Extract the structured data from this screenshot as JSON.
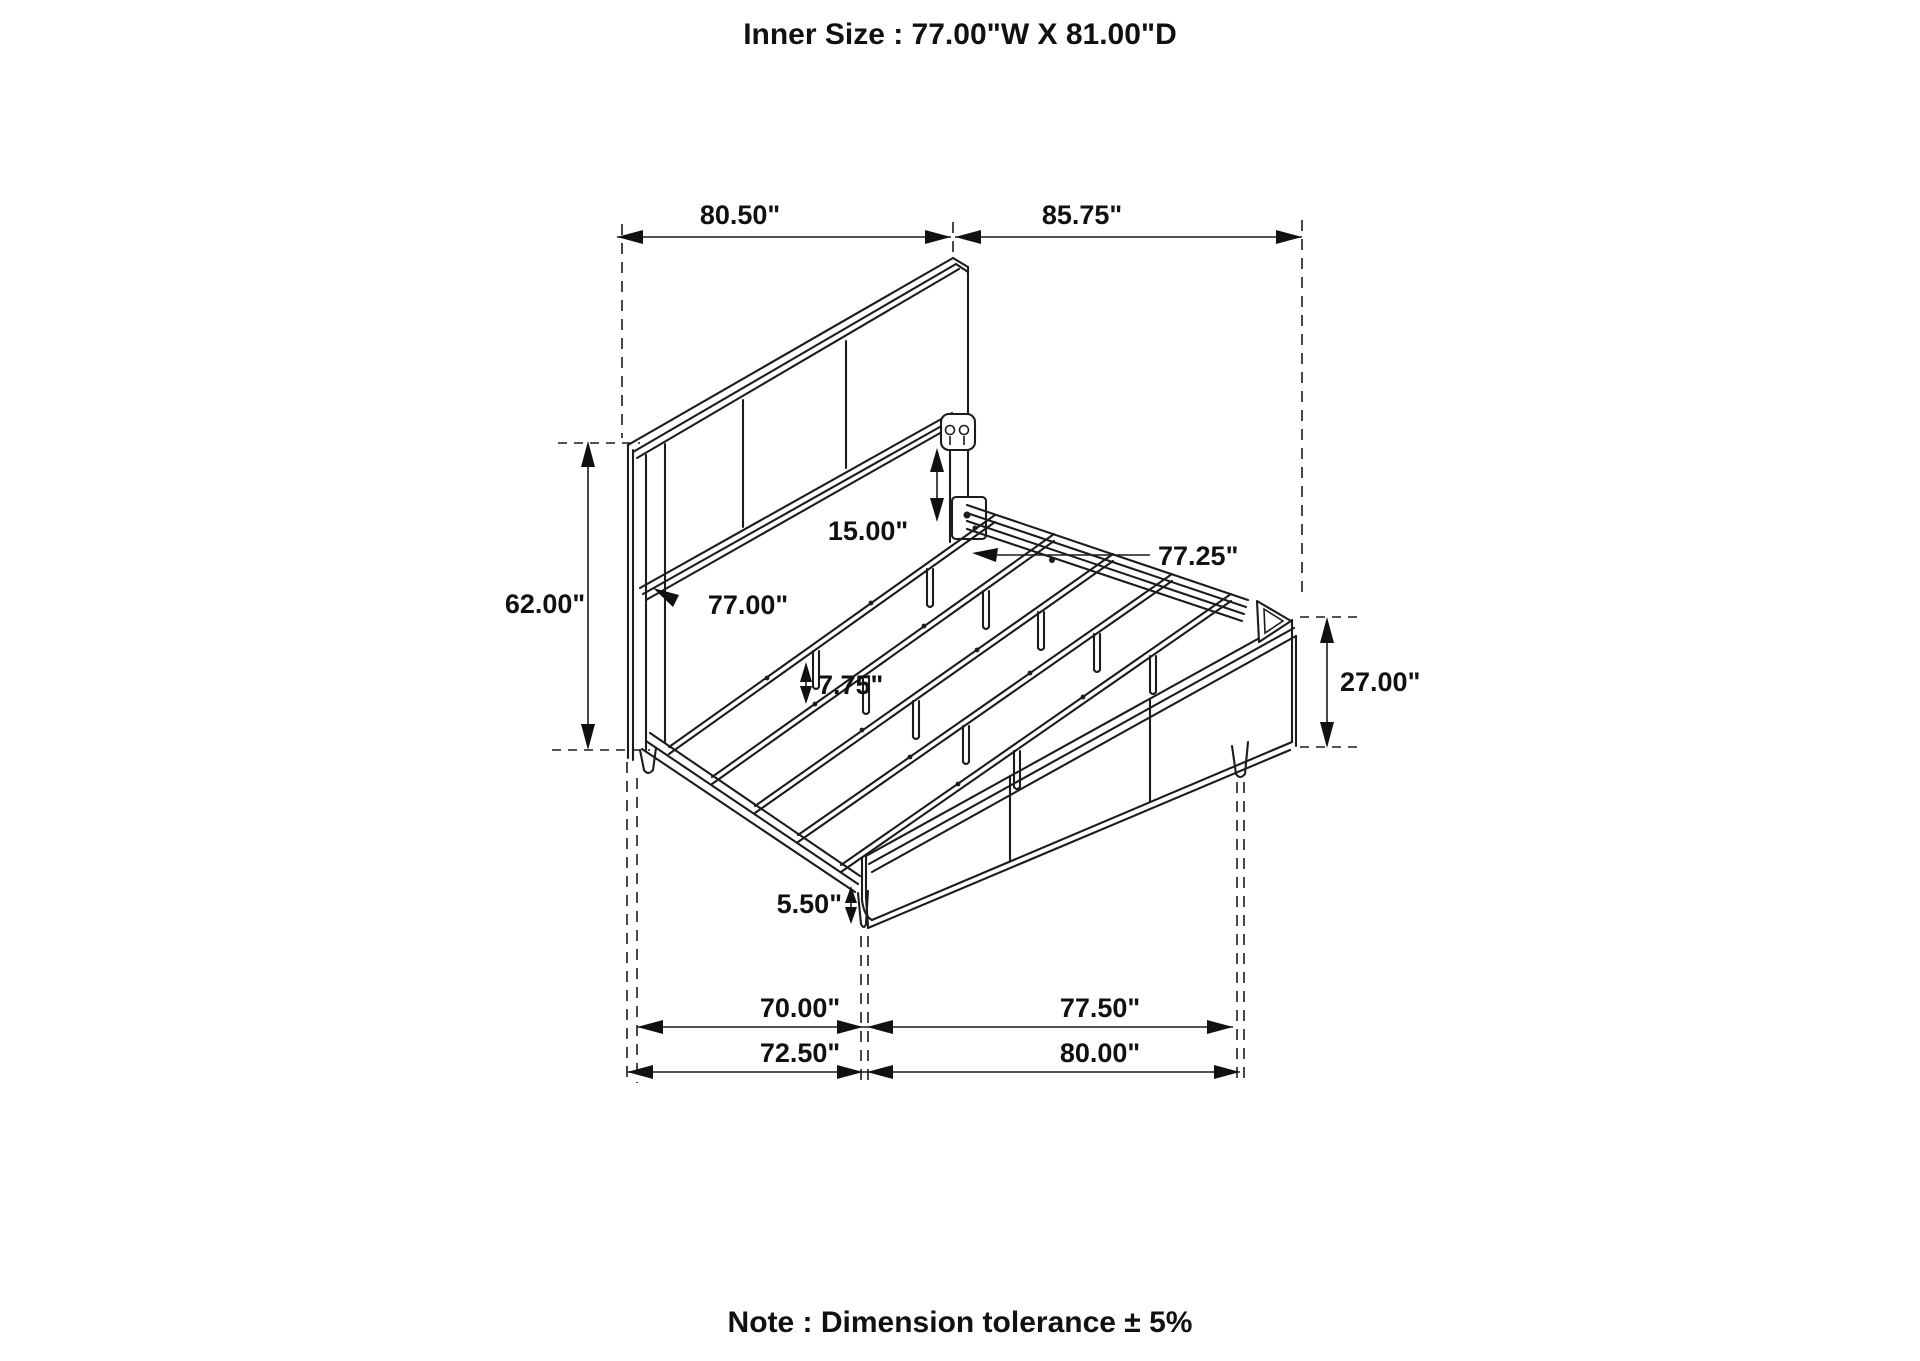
{
  "title": "Inner Size : 77.00\"W X 81.00\"D",
  "note": "Note : Dimension tolerance ± 5%",
  "dims": {
    "top_width": "80.50\"",
    "top_depth": "85.75\"",
    "headboard_height": "62.00\"",
    "bracket_offset": "15.00\"",
    "rail_length": "77.25\"",
    "headboard_width": "77.00\"",
    "slat_leg_height": "7.75\"",
    "footboard_height": "27.00\"",
    "front_leg_height": "5.50\"",
    "inner_width": "70.00\"",
    "inner_depth": "77.50\"",
    "outer_width": "72.50\"",
    "outer_depth": "80.00\""
  },
  "colors": {
    "line": "#1c1c1c",
    "background": "#ffffff"
  }
}
